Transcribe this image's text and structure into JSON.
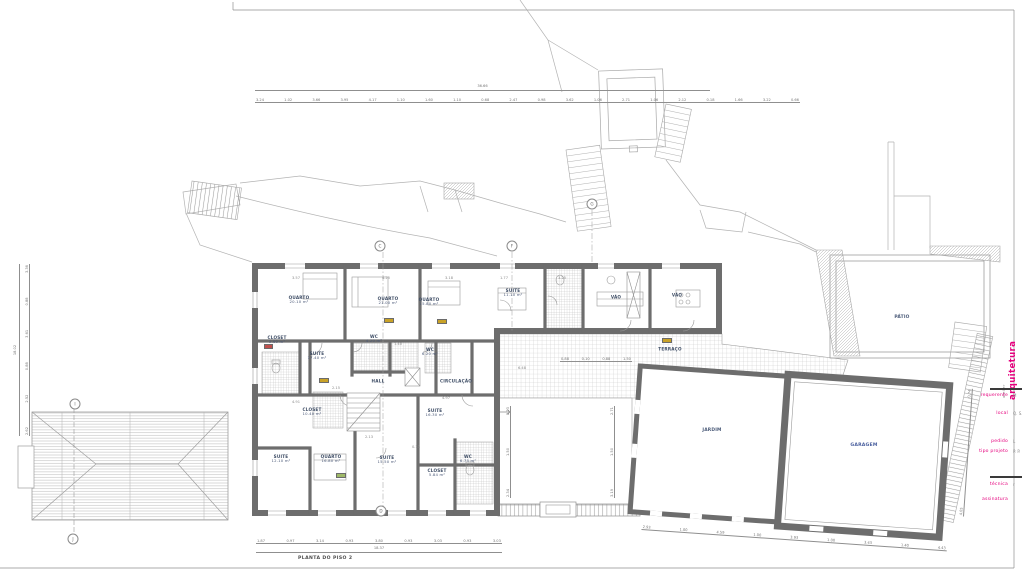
{
  "sheet": {
    "title": "PLANTA DO PISO 2"
  },
  "title_block": {
    "atelier": "atelier",
    "studio": "arquitetura",
    "fields": [
      {
        "label": "requerente",
        "value": "M"
      },
      {
        "label": "local",
        "value": "Q. S."
      },
      {
        "label": "pedido",
        "value": "L"
      },
      {
        "label": "tipo projeto",
        "value": "P. P."
      },
      {
        "label": "técnica",
        "value": "r"
      },
      {
        "label": "assinatura",
        "value": ""
      }
    ],
    "accent_color": "#e5007d"
  },
  "rooms": [
    {
      "name": "QUARTO",
      "area": "20.10 m²"
    },
    {
      "name": "CLOSET",
      "area": "5.60 m²"
    },
    {
      "name": "SUITE",
      "area": "17.40 m²"
    },
    {
      "name": "QUARTO",
      "area": "21.00 m²"
    },
    {
      "name": "WC",
      "area": "4.20 m²"
    },
    {
      "name": "QUARTO",
      "area": "15.80 m²"
    },
    {
      "name": "WC",
      "area": "6.20 m²"
    },
    {
      "name": "SUITE",
      "area": "11.10 m²"
    },
    {
      "name": "HALL",
      "area": ""
    },
    {
      "name": "CIRCULAÇÃO",
      "area": ""
    },
    {
      "name": "VÃO",
      "area": ""
    },
    {
      "name": "VÃO",
      "area": ""
    },
    {
      "name": "TERRAÇO",
      "area": ""
    },
    {
      "name": "CLOSET",
      "area": "10.40 m²"
    },
    {
      "name": "SUITE",
      "area": "12.10 m²"
    },
    {
      "name": "QUARTO",
      "area": "16.80 m²"
    },
    {
      "name": "SUITE",
      "area": "15.50 m²"
    },
    {
      "name": "SUITE",
      "area": "16.30 m²"
    },
    {
      "name": "CLOSET",
      "area": "5.84 m²"
    },
    {
      "name": "WC",
      "area": "6.75 m²"
    }
  ],
  "site": {
    "patio": "PÁTIO",
    "jardim": "JARDIM",
    "garagem": "GARAGEM"
  },
  "markers": {
    "c": "C",
    "f": "F",
    "g": "G",
    "d": "D",
    "i": "I",
    "j": "J"
  },
  "dims": {
    "top": {
      "total": "36.66",
      "values": [
        "3.24",
        "1.02",
        "3.66",
        "3.95",
        "4.17",
        "1.10",
        "1.60",
        "1.10",
        "0.68",
        "2.47",
        "0.98",
        "3.62",
        "1.06",
        "2.71",
        "1.06",
        "2.12",
        "0.18",
        "1.66",
        "3.22",
        "0.66"
      ]
    },
    "bottom": {
      "total": "18.37",
      "values": [
        "1.87",
        "0.97",
        "3.14",
        "0.93",
        "3.80",
        "0.93",
        "3.03",
        "0.93",
        "3.03"
      ]
    },
    "left": {
      "total": "18.02",
      "values": [
        "2.62",
        "2.52",
        "0.88",
        "3.61",
        "0.88",
        "3.36"
      ]
    },
    "garden_bottom": {
      "values": [
        "2.93",
        "1.00",
        "4.59",
        "1.00",
        "3.93",
        "1.00",
        "3.43",
        "1.40",
        "4.43"
      ]
    },
    "terrace": {
      "values": [
        "0.88",
        "0.10",
        "0.88",
        "1.50"
      ]
    },
    "courtyard_left": {
      "values": [
        "2.34",
        "1.50",
        "2.23"
      ]
    },
    "courtyard_right": {
      "values": [
        "3.19",
        "1.50",
        "2.71"
      ]
    },
    "garage_right": {
      "values": [
        "4.05",
        "0.74"
      ]
    },
    "plan": [
      "3.57",
      "4.25",
      "3.18",
      "1.77",
      "3.25",
      "1.40",
      "2.13",
      "4.91",
      "4.97",
      "6.48",
      "2.15",
      "0.13"
    ]
  }
}
